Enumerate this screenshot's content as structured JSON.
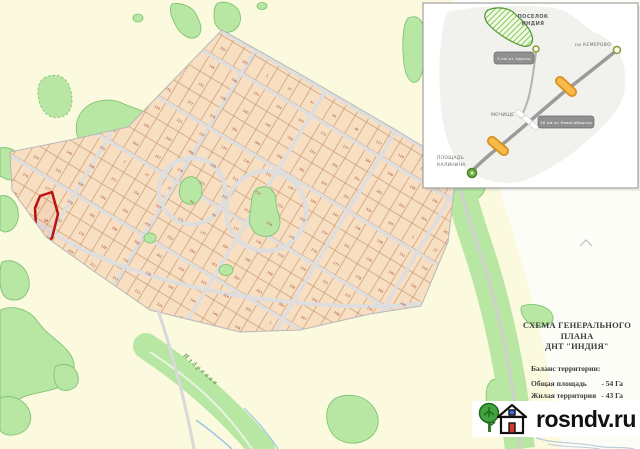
{
  "inset_map": {
    "poselok_label_line1": "ПОСЕЛОК",
    "poselok_label_line2": "ИНДИЯ",
    "kemerovo_label": "на КЕМЕРОВО",
    "mochishche_label": "МОЧИЩЕ",
    "kalinina_label_line1": "ПЛОЩАДЬ",
    "kalinina_label_line2": "КАЛИНИНА",
    "road_sign_top": "5 км от трассы",
    "road_sign_bottom": "30 км от Новосибирска"
  },
  "legend": {
    "title_line1": "СХЕМА ГЕНЕРАЛЬНОГО ПЛАНА",
    "title_line2": "ДНТ \"ИНДИЯ\"",
    "balance_heading": "Баланс территории:",
    "rows": [
      {
        "label": "Общая площадь",
        "value": "- 54 Га"
      },
      {
        "label": "Жилая территория",
        "value": "- 43 Га"
      },
      {
        "label": "Улицы, дороги",
        "value": "- 11 Га"
      }
    ]
  },
  "watermark": {
    "site": "rosndv.ru"
  },
  "main_map": {
    "river_label": "Издревая",
    "highlighted_lot_number": "39",
    "sample_lot_numbers": [
      "1",
      "27",
      "37",
      "44",
      "49",
      "117",
      "118",
      "119",
      "120",
      "121",
      "122",
      "126",
      "128",
      "131",
      "135",
      "140",
      "144",
      "146",
      "148",
      "151",
      "154",
      "163",
      "171",
      "177",
      "184",
      "190",
      "198",
      "199",
      "203",
      "208",
      "209",
      "211",
      "213",
      "215",
      "216",
      "224",
      "231",
      "236",
      "240",
      "245",
      "250",
      "253",
      "256",
      "261",
      "262",
      "263",
      "264",
      "267",
      "270",
      "271",
      "272",
      "273",
      "274",
      "275",
      "276",
      "277",
      "278",
      "281",
      "290",
      "298",
      "301",
      "310",
      "315",
      "320",
      "325"
    ],
    "colors": {
      "background": "#fbf9de",
      "background_east": "#fdfdf8",
      "lot_fill": "#f8dfc2",
      "lot_border": "#c89a74",
      "street": "#dedede",
      "forest": "#b7e7a2",
      "forest_border": "#79bf70",
      "highlight": "#bb1111",
      "water": "#9cc6e2",
      "lot_number": "#a2402a",
      "bridge_orange": "#f0a838"
    }
  }
}
